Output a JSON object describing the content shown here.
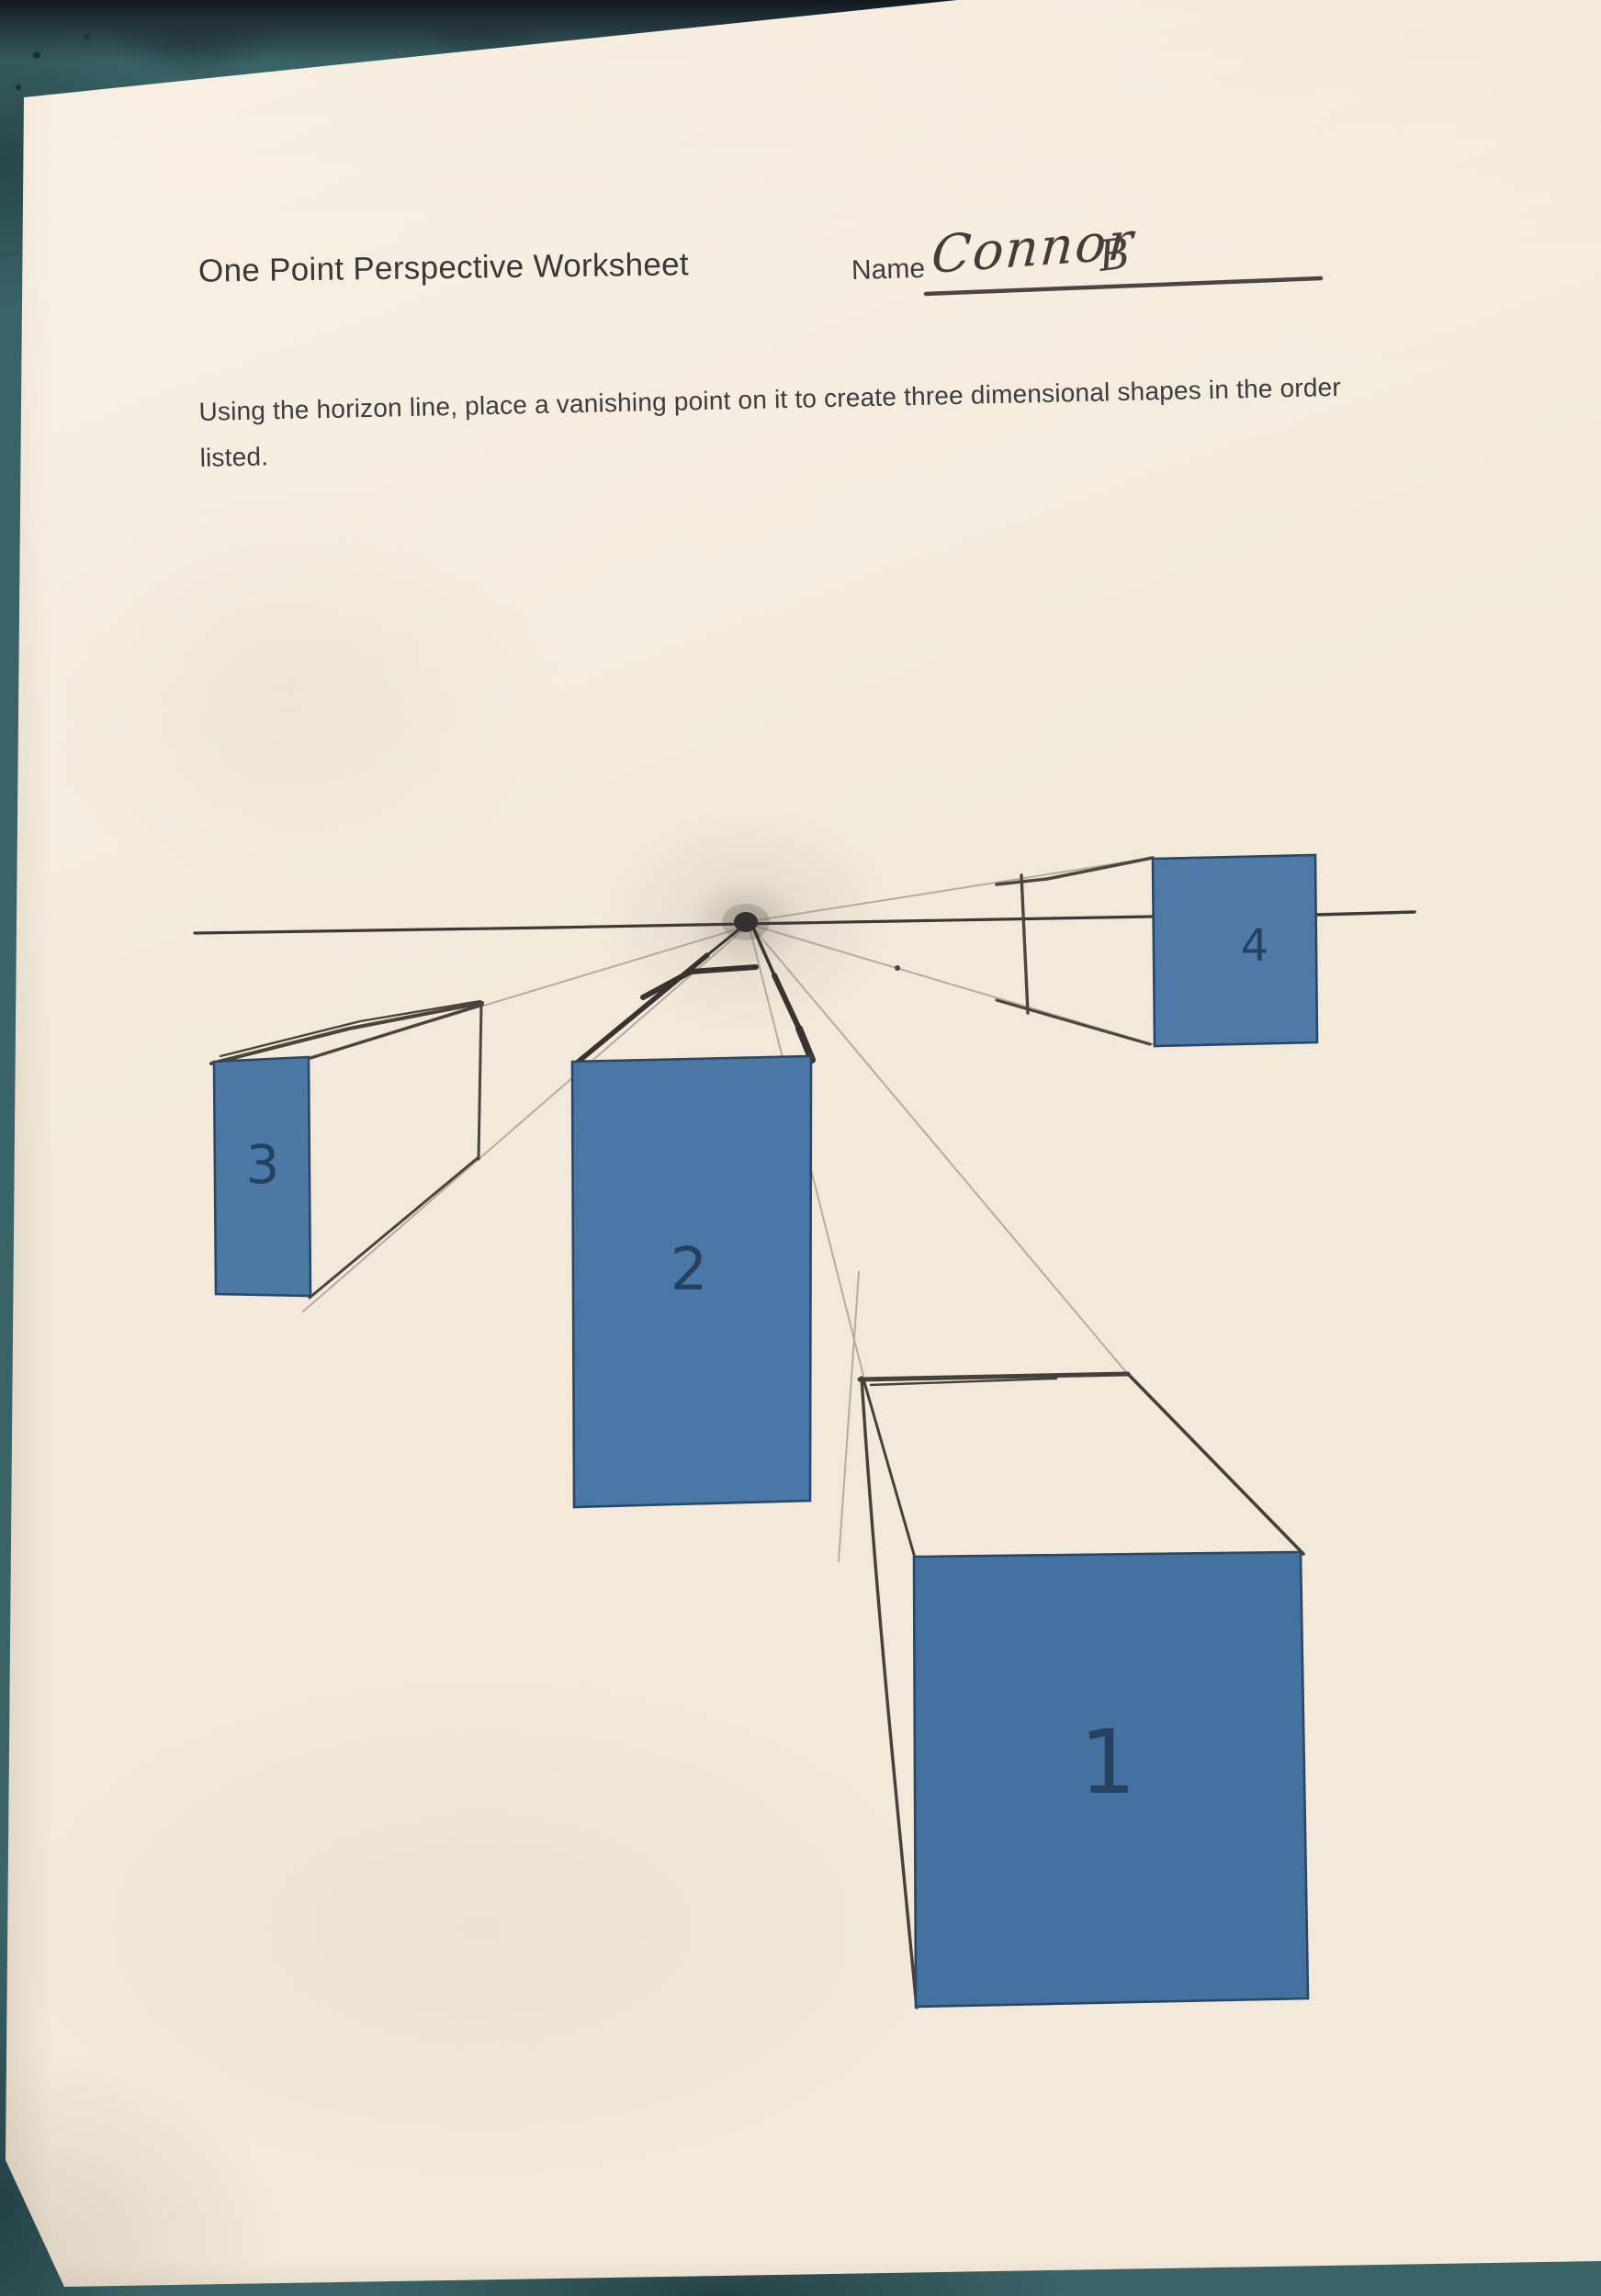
{
  "document": {
    "title": "One Point Perspective Worksheet",
    "name_label": "Name",
    "student_name": "Connor",
    "student_initial": "B",
    "instructions": "Using the horizon line, place a vanishing point on it to create three dimensional shapes in the order listed."
  },
  "drawing": {
    "boxes": [
      {
        "label": "1"
      },
      {
        "label": "2"
      },
      {
        "label": "3"
      },
      {
        "label": "4"
      }
    ]
  },
  "colors": {
    "background_teal": "#3a6367",
    "paper_cream": "#f2e9da",
    "box_fill": "#4a77a6",
    "box_stroke": "#2a4765",
    "number_navy": "#24415f",
    "pencil_dark": "#38332e",
    "pencil_mid": "#4c463f",
    "pencil_faint": "#8d857b",
    "ink_line": "#4b4543"
  }
}
